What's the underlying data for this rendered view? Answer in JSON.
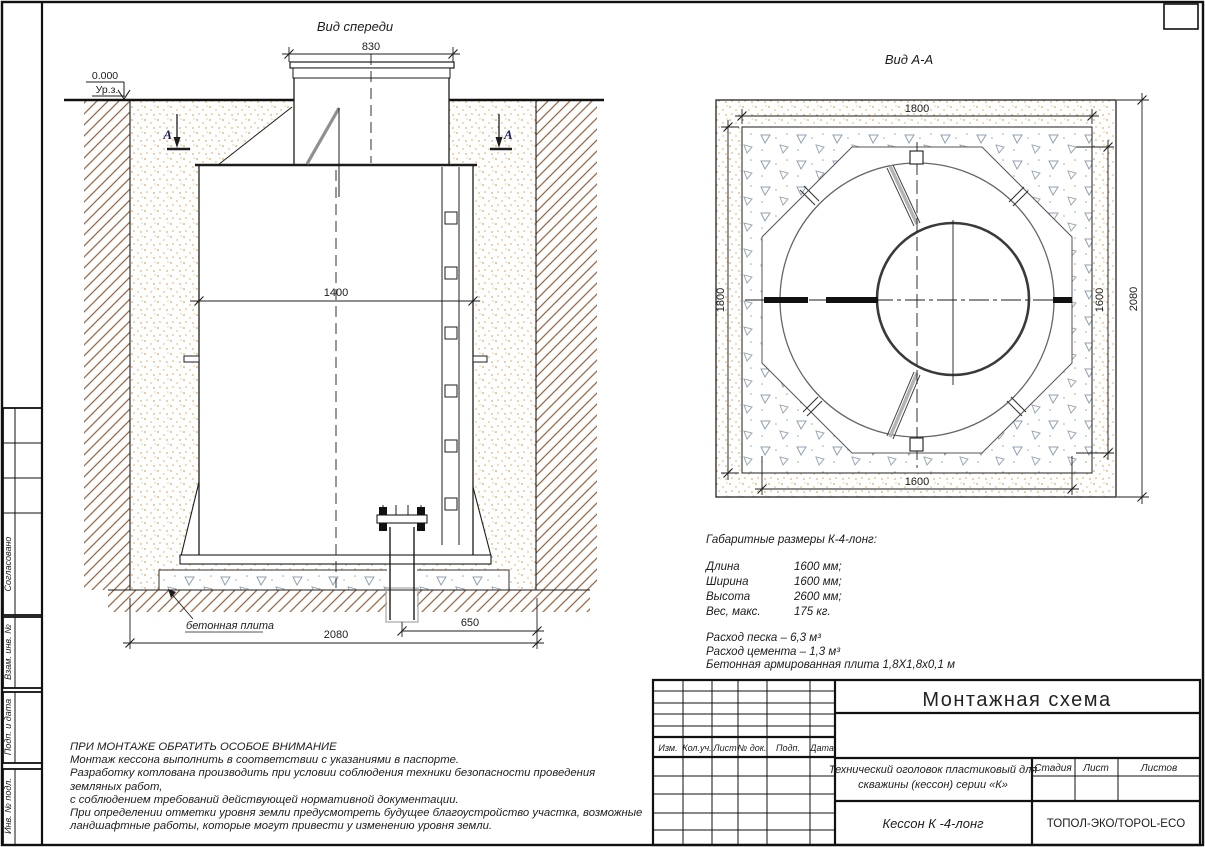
{
  "front_view": {
    "title": "Вид спереди",
    "dim_lid": "830",
    "dim_width": "1400",
    "dim_base": "2080",
    "dim_pipe": "650",
    "elevation_value": "0.000",
    "elevation_label": "Ур.з.",
    "section_letter_left": "А",
    "section_letter_right": "А",
    "slab_label": "бетонная плита"
  },
  "section_view": {
    "title": "Вид А-А",
    "dim_top": "1800",
    "dim_left": "1800",
    "dim_right_inner": "1600",
    "dim_right_outer": "2080",
    "dim_bottom": "1600"
  },
  "specs": {
    "heading": "Габаритные размеры К-4-лонг:",
    "rows": [
      {
        "label": "Длина",
        "value": "1600 мм;"
      },
      {
        "label": "Ширина",
        "value": "1600 мм;"
      },
      {
        "label": "Высота",
        "value": "2600 мм;"
      },
      {
        "label": "Вес, макс.",
        "value": "175 кг."
      }
    ],
    "notes": [
      "Расход песка – 6,3 м³",
      "Расход цемента – 1,3 м³",
      "Бетонная армированная плита 1,8Х1,8х0,1 м"
    ]
  },
  "warning": {
    "title": "ПРИ МОНТАЖЕ ОБРАТИТЬ ОСОБОЕ ВНИМАНИЕ",
    "lines": [
      "Монтаж кессона выполнить в соответствии с указаниями в паспорте.",
      "Разработку котлована производить при условии соблюдения техники безопасности проведения земляных работ,",
      "с соблюдением требований действующей нормативной документации.",
      "При определении отметки уровня земли предусмотреть будущее благоустройство участка, возможные",
      "ландшафтные работы, которые могут привести у изменению уровня земли."
    ]
  },
  "title_block": {
    "drawing_title": "Монтажная схема",
    "revision_headers": [
      "Изм.",
      "Кол.уч.",
      "Лист",
      "№ док.",
      "Подп.",
      "Дата"
    ],
    "document_name_line1": "Технический оголовок пластиковый для",
    "document_name_line2": "скважины (кессон) серии «К»",
    "stage_label": "Стадия",
    "sheet_label": "Лист",
    "sheets_label": "Листов",
    "product_name": "Кессон К -4-лонг",
    "company": "ТОПОЛ-ЭКО/TOPOL-ECO"
  },
  "sidebar": {
    "labels": [
      "Согласовано",
      "Взам. инв. №",
      "Подп. и дата",
      "Инв. № подл."
    ]
  },
  "colors": {
    "line": "#1c1c1c",
    "sand_dots": "#dda45c",
    "soil_hatch": "#9a6a4a",
    "concrete": "#8fa0b0",
    "section_mark": "#23235e"
  }
}
